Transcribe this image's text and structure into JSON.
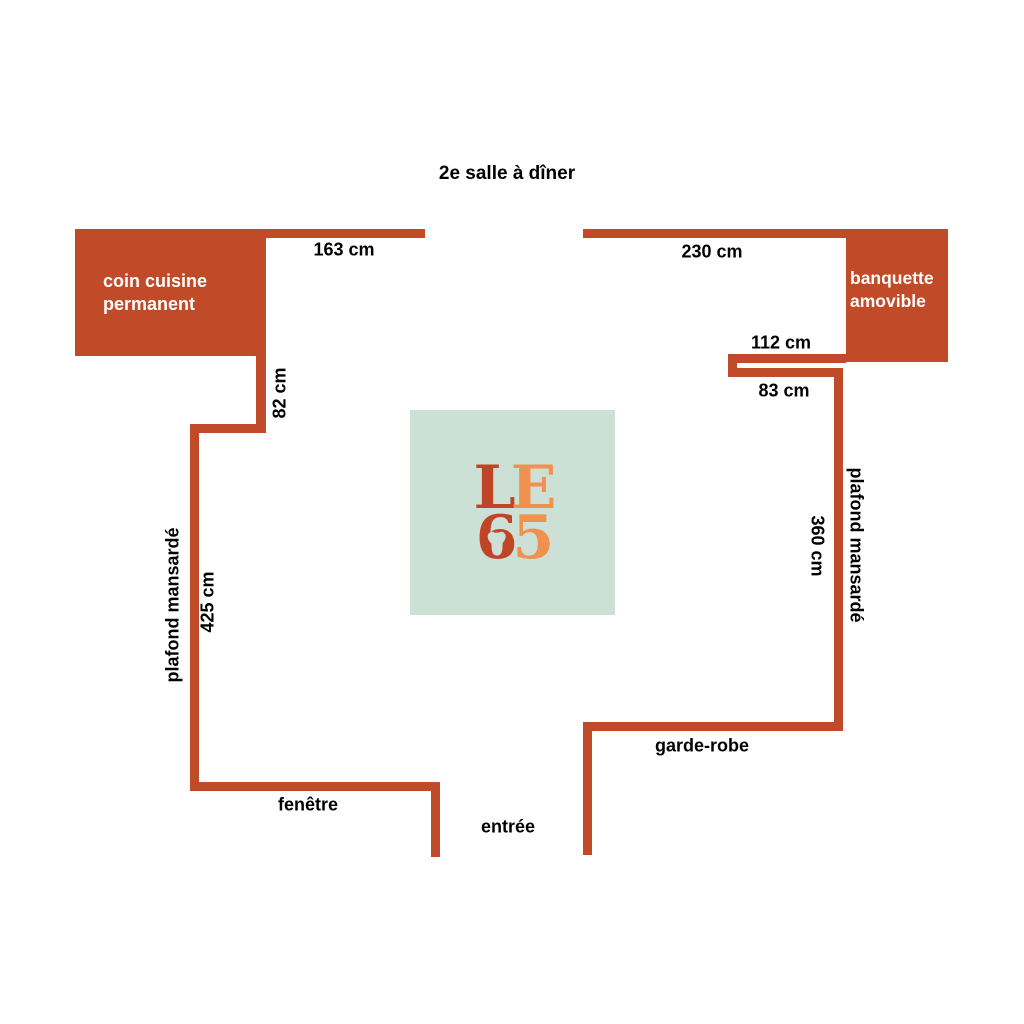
{
  "title": "2e salle à dîner",
  "rooms": {
    "kitchen": {
      "line1": "coin cuisine",
      "line2": "permanent"
    },
    "banquette": {
      "line1": "banquette",
      "line2": "amovible"
    }
  },
  "dimensions": {
    "top_left_wall": "163 cm",
    "top_right_wall": "230 cm",
    "banquette_return": "112 cm",
    "right_step": "83 cm",
    "kitchen_return": "82 cm",
    "left_wall": "425 cm",
    "right_wall": "360 cm"
  },
  "labels": {
    "left_ceiling": "plafond mansardé",
    "right_ceiling": "plafond mansardé",
    "window": "fenêtre",
    "entrance": "entrée",
    "wardrobe": "garde-robe"
  },
  "logo": {
    "letter1": "L",
    "letter2": "E",
    "letter3": "6",
    "letter4": "5",
    "heart": "♥"
  },
  "colors": {
    "wall": "#c14a28",
    "mint": "#cde0d5",
    "logo_dark": "#c04527",
    "logo_orange": "#f0914f"
  }
}
